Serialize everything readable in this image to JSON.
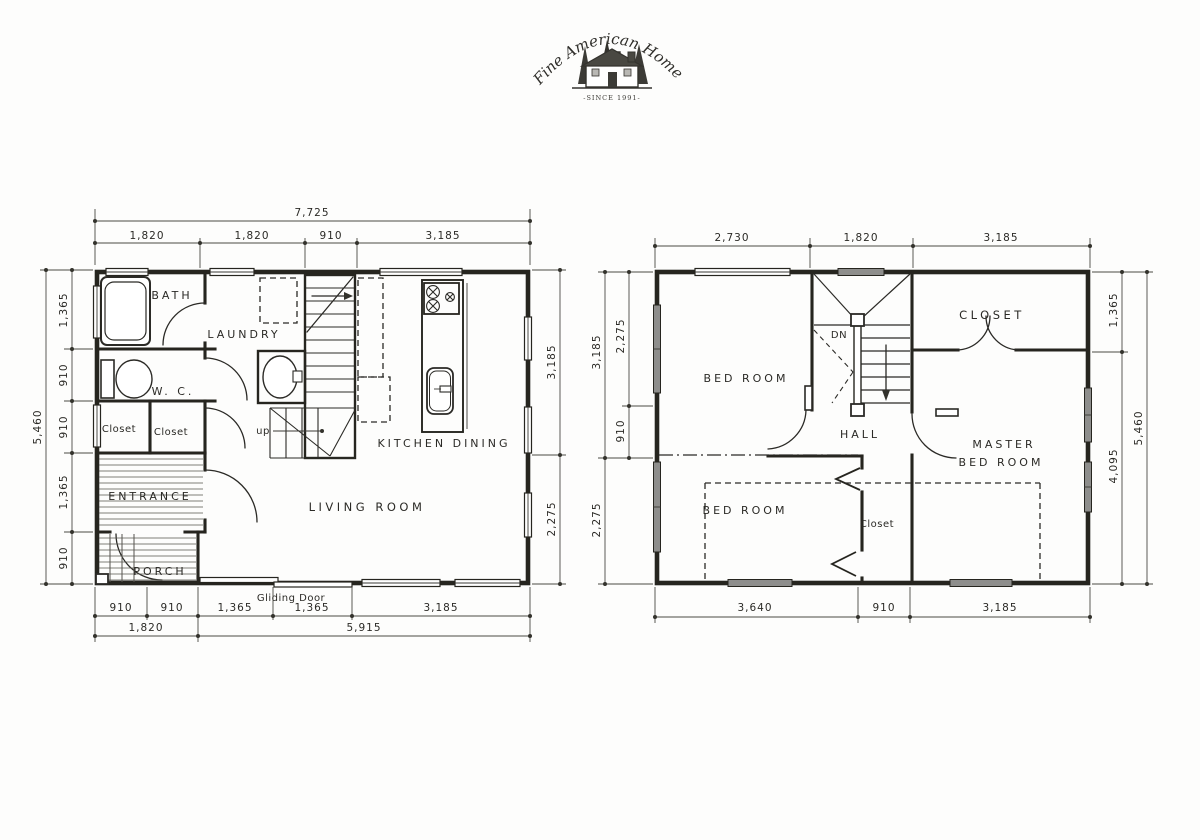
{
  "logo": {
    "title": "Fine American Homes",
    "since": "-SINCE 1991-"
  },
  "first_floor": {
    "rooms": {
      "bath": "BATH",
      "laundry": "LAUNDRY",
      "wc": "W. C.",
      "closet_a": "Closet",
      "closet_b": "Closet",
      "entrance": "ENTRANCE",
      "porch": "PORCH",
      "kitchen_dining": "KITCHEN DINING",
      "living": "LIVING ROOM"
    },
    "stair_label": "up",
    "gliding_door": "Gliding Door",
    "dims": {
      "top_total": "7,725",
      "top": [
        "1,820",
        "1,820",
        "910",
        "3,185"
      ],
      "left_total": "5,460",
      "left": [
        "1,365",
        "910",
        "910",
        "1,365",
        "910"
      ],
      "right": [
        "3,185",
        "2,275"
      ],
      "bottom": [
        "910",
        "910",
        "1,365",
        "1,365",
        "3,185"
      ],
      "bottom_totals": [
        "1,820",
        "5,915"
      ]
    }
  },
  "second_floor": {
    "rooms": {
      "bedroom_top": "BED ROOM",
      "closet_top": "CLOSET",
      "hall": "HALL",
      "master_line1": "MASTER",
      "master_line2": "BED ROOM",
      "bedroom_bottom": "BED ROOM",
      "closet_bottom": "Closet"
    },
    "stair_label": "DN",
    "dims": {
      "top": [
        "2,730",
        "1,820",
        "3,185"
      ],
      "left_outer": [
        "3,185",
        "2,275"
      ],
      "left_inner": [
        "2,275",
        "910"
      ],
      "right_inner": [
        "1,365",
        "4,095"
      ],
      "right_total": "5,460",
      "bottom": [
        "3,640",
        "910",
        "3,185"
      ]
    }
  }
}
